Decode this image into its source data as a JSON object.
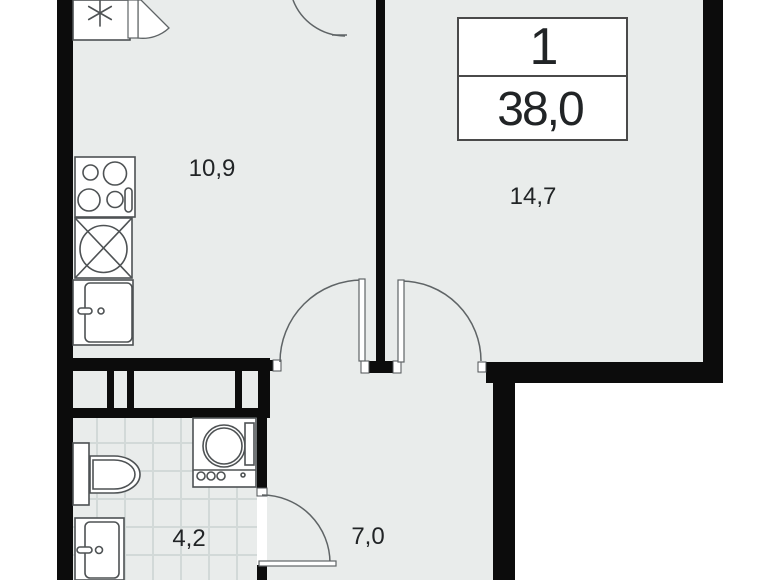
{
  "plan": {
    "info_box": {
      "unit_number": "1",
      "total_area": "38,0"
    },
    "rooms": [
      {
        "id": "kitchen",
        "area_label": "10,9"
      },
      {
        "id": "living-room",
        "area_label": "14,7"
      },
      {
        "id": "bathroom",
        "area_label": "4,2"
      },
      {
        "id": "hallway",
        "area_label": "7,0"
      }
    ],
    "fixture_icons": [
      "fridge-icon",
      "stove-icon",
      "kitchen-sink-icon",
      "cabinet-sink-icon",
      "toilet-icon",
      "washing-machine-icon",
      "washbasin-icon",
      "door-swing-icon"
    ]
  },
  "colors": {
    "outside": "#ffffff",
    "floor": "#e9eceb",
    "wall": "#0c0c0c",
    "fixture": "#4e5254",
    "door": "#5f6466",
    "tile": "#d2d9d8",
    "ink": "#212426",
    "infoborder": "#4a4a4a"
  }
}
